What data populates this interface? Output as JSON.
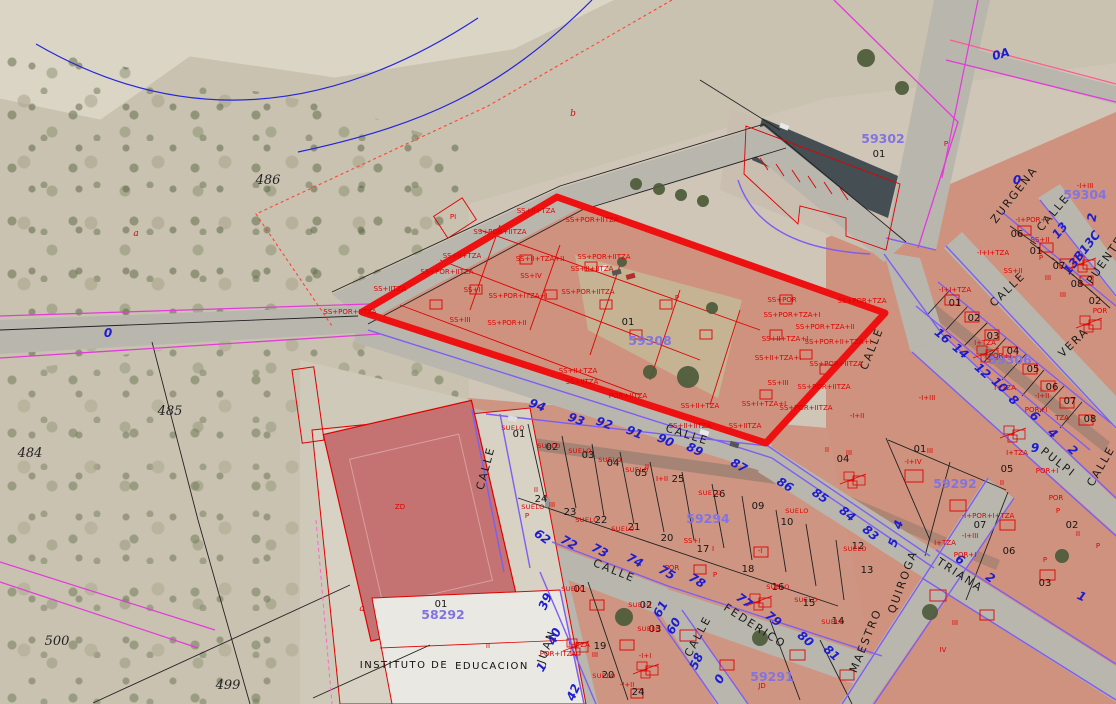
{
  "map": {
    "type": "cadastral-aerial-viewer",
    "highlight": {
      "code": "59308",
      "parcel": "01"
    }
  },
  "colors": {
    "highlight_red": "#ee1111",
    "cadastral_red": "#e00000",
    "street_violet": "#7e5ef2",
    "parcel_purple": "#8274e0",
    "number_blue": "#1d1dcf",
    "magenta": "#e23bd9",
    "contour_blue": "#2626d8",
    "road_gray": "#b9b6ae",
    "block_salmon": "#cf927e"
  },
  "labels": {
    "parcel_codes": [
      [
        "59302",
        883,
        143
      ],
      [
        "59304",
        1085,
        199
      ],
      [
        "59306",
        1010,
        364
      ],
      [
        "59308",
        650,
        345,
        0,
        15
      ],
      [
        "59294",
        708,
        523
      ],
      [
        "59292",
        955,
        488
      ],
      [
        "58292",
        443,
        619
      ],
      [
        "59291",
        772,
        681
      ]
    ],
    "street_names": [
      [
        "ZURGENA",
        1017,
        197,
        -52
      ],
      [
        "CALLE",
        1056,
        215,
        -50
      ],
      [
        "PUENTE",
        1108,
        262,
        -55
      ],
      [
        "CALLE",
        1010,
        292,
        -44
      ],
      [
        "VERA",
        1076,
        345,
        -44
      ],
      [
        "CALLE",
        875,
        350,
        -68
      ],
      [
        "CALLE",
        1104,
        468,
        -60
      ],
      [
        "PULPI",
        1056,
        465,
        38
      ],
      [
        "CALLE",
        686,
        438,
        18
      ],
      [
        "CALLE",
        489,
        469,
        -75
      ],
      [
        "CALLE",
        613,
        574,
        22
      ],
      [
        "FEDERICO",
        753,
        629,
        33
      ],
      [
        "CALLE",
        701,
        638,
        -62
      ],
      [
        "JUAN",
        550,
        648,
        -70
      ],
      [
        "MAESTRO",
        869,
        642,
        -68
      ],
      [
        "QUIROGA",
        906,
        583,
        -70
      ],
      [
        "TRIANA",
        958,
        578,
        33
      ]
    ],
    "street_numbers": [
      [
        "94",
        536,
        409,
        20
      ],
      [
        "93",
        575,
        423,
        20
      ],
      [
        "92",
        603,
        427,
        20
      ],
      [
        "91",
        633,
        436,
        22
      ],
      [
        "90",
        664,
        444,
        24
      ],
      [
        "89",
        693,
        453,
        26
      ],
      [
        "87",
        737,
        469,
        30
      ],
      [
        "86",
        783,
        488,
        32
      ],
      [
        "85",
        818,
        499,
        34
      ],
      [
        "84",
        845,
        517,
        38
      ],
      [
        "83",
        868,
        536,
        40
      ],
      [
        "62",
        540,
        540,
        36
      ],
      [
        "72",
        567,
        546,
        30
      ],
      [
        "73",
        598,
        554,
        28
      ],
      [
        "74",
        633,
        564,
        28
      ],
      [
        "75",
        665,
        576,
        30
      ],
      [
        "78",
        695,
        584,
        32
      ],
      [
        "77",
        742,
        604,
        36
      ],
      [
        "79",
        771,
        622,
        38
      ],
      [
        "80",
        803,
        642,
        40
      ],
      [
        "81",
        829,
        656,
        42
      ],
      [
        "39",
        549,
        603,
        -66
      ],
      [
        "40",
        558,
        638,
        -66
      ],
      [
        "42",
        577,
        694,
        -66
      ],
      [
        "1",
        545,
        669,
        -60
      ],
      [
        "61",
        664,
        611,
        -60
      ],
      [
        "60",
        677,
        628,
        -60
      ],
      [
        "58",
        700,
        663,
        -64
      ],
      [
        "0",
        723,
        681,
        -60
      ],
      [
        "16",
        940,
        339,
        40
      ],
      [
        "14",
        958,
        354,
        40
      ],
      [
        "12",
        980,
        374,
        42
      ],
      [
        "10",
        997,
        388,
        42
      ],
      [
        "8",
        1011,
        403,
        42
      ],
      [
        "6",
        1032,
        419,
        44
      ],
      [
        "4",
        1050,
        436,
        44
      ],
      [
        "2",
        1070,
        453,
        44
      ],
      [
        "9",
        1035,
        452,
        0
      ],
      [
        "0",
        1017,
        184,
        0
      ],
      [
        "13",
        1063,
        233,
        -50
      ],
      [
        "13B13C",
        1085,
        255,
        -52
      ],
      [
        "2",
        1096,
        218,
        -80
      ],
      [
        "0A",
        1002,
        58,
        -15
      ],
      [
        "0",
        108,
        337,
        0
      ],
      [
        "5",
        897,
        544,
        -70
      ],
      [
        "4",
        902,
        526,
        -70
      ],
      [
        "6",
        958,
        563,
        33
      ],
      [
        "2",
        988,
        581,
        35
      ],
      [
        "1",
        1080,
        600,
        25
      ]
    ],
    "parcel_numbers": [
      [
        "01",
        879,
        157
      ],
      [
        "01",
        628,
        325
      ],
      [
        "01",
        441,
        607
      ],
      [
        "01",
        920,
        452
      ],
      [
        "04",
        843,
        462
      ],
      [
        "05",
        1007,
        472
      ],
      [
        "07",
        980,
        528
      ],
      [
        "06",
        1009,
        554
      ],
      [
        "02",
        1072,
        528
      ],
      [
        "03",
        1045,
        586
      ],
      [
        "12",
        858,
        549
      ],
      [
        "13",
        867,
        573
      ],
      [
        "01",
        955,
        306
      ],
      [
        "02",
        974,
        321
      ],
      [
        "03",
        993,
        339
      ],
      [
        "04",
        1013,
        354
      ],
      [
        "05",
        1033,
        372
      ],
      [
        "06",
        1052,
        390
      ],
      [
        "07",
        1070,
        404
      ],
      [
        "08",
        1090,
        422
      ],
      [
        "06",
        1017,
        237
      ],
      [
        "01",
        1036,
        254
      ],
      [
        "07",
        1059,
        269
      ],
      [
        "08",
        1077,
        287
      ],
      [
        "02",
        1095,
        304
      ],
      [
        "01",
        519,
        437
      ],
      [
        "02",
        552,
        450
      ],
      [
        "03",
        588,
        458
      ],
      [
        "04",
        613,
        466
      ],
      [
        "05",
        641,
        476
      ],
      [
        "25",
        678,
        482
      ],
      [
        "26",
        719,
        497
      ],
      [
        "09",
        758,
        509
      ],
      [
        "10",
        787,
        525
      ],
      [
        "24",
        541,
        502
      ],
      [
        "23",
        570,
        515
      ],
      [
        "22",
        601,
        523
      ],
      [
        "21",
        634,
        530
      ],
      [
        "20",
        667,
        541
      ],
      [
        "17",
        703,
        552
      ],
      [
        "18",
        748,
        572
      ],
      [
        "16",
        778,
        590
      ],
      [
        "15",
        809,
        606
      ],
      [
        "14",
        838,
        624
      ],
      [
        "01",
        580,
        592
      ],
      [
        "02",
        646,
        608
      ],
      [
        "03",
        655,
        632
      ],
      [
        "19",
        600,
        649
      ],
      [
        "20",
        608,
        678
      ],
      [
        "24",
        638,
        695
      ]
    ],
    "construction": [
      [
        "SS+II+TZA",
        536,
        213
      ],
      [
        "SS+POR+IITZA",
        592,
        222
      ],
      [
        "SS+POR+IITZA",
        500,
        234
      ],
      [
        "SS+II+TZA",
        462,
        258
      ],
      [
        "SS+II+TZA+II",
        540,
        261
      ],
      [
        "SS+POR+IITZA",
        604,
        259
      ],
      [
        "SS+II+IITZA",
        592,
        271
      ],
      [
        "SS+POR+IITZA",
        447,
        274
      ],
      [
        "SS+IV",
        531,
        278
      ],
      [
        "SS+I",
        472,
        292
      ],
      [
        "SS+POR+ITZA+I",
        518,
        298
      ],
      [
        "SS+POR+IITZA",
        588,
        294
      ],
      [
        "SS+III",
        460,
        322
      ],
      [
        "SS+POR+II",
        507,
        325
      ],
      [
        "SS+POR+IITZA",
        350,
        314
      ],
      [
        "SS+IITZA",
        390,
        291
      ],
      [
        "SS+II+TZA",
        578,
        373
      ],
      [
        "SS+IITZA",
        582,
        384
      ],
      [
        "POR+IITZA",
        628,
        398
      ],
      [
        "SS+II+TZA",
        700,
        408
      ],
      [
        "SS+II+IITZA",
        690,
        428
      ],
      [
        "SS+POR",
        782,
        302
      ],
      [
        "SS+POR+TZA",
        862,
        303
      ],
      [
        "SS+POR+TZA+I",
        792,
        317
      ],
      [
        "SS+POR+TZA+II",
        825,
        329
      ],
      [
        "SS+II+TZA+I",
        785,
        341
      ],
      [
        "SS+POR+II+TZA+I",
        838,
        344
      ],
      [
        "SS+II+TZA+I",
        778,
        360
      ],
      [
        "SS+POR+IITZA",
        836,
        366
      ],
      [
        "SS+III",
        778,
        385
      ],
      [
        "SS+POR+IITZA",
        824,
        389
      ],
      [
        "SS+I+TZA+I",
        764,
        406
      ],
      [
        "SS+POR+IITZA",
        806,
        410
      ],
      [
        "SS+IITZA",
        745,
        428
      ],
      [
        "P",
        946,
        146
      ],
      [
        "PI",
        453,
        219
      ],
      [
        "P",
        677,
        300
      ],
      [
        "-I+III",
        1085,
        188
      ],
      [
        "-I+POR+I",
        1032,
        222
      ],
      [
        "SS+II",
        1040,
        242
      ],
      [
        "SS+II",
        1013,
        273
      ],
      [
        "-I+I+TZA",
        993,
        255
      ],
      [
        "-I+I+TZA",
        955,
        292
      ],
      [
        "III",
        1048,
        280
      ],
      [
        "III",
        1063,
        297
      ],
      [
        "POR",
        1100,
        313
      ],
      [
        "P",
        1041,
        260
      ],
      [
        "-I+III",
        927,
        400
      ],
      [
        "-I+II",
        857,
        418
      ],
      [
        "I+TZA",
        1017,
        455
      ],
      [
        "POR+I",
        1047,
        473
      ],
      [
        "I+TZA",
        1005,
        390
      ],
      [
        "-I+II",
        1042,
        398
      ],
      [
        "POR+I",
        1036,
        412
      ],
      [
        "TZA",
        1062,
        420
      ],
      [
        "I+TZA",
        985,
        345
      ],
      [
        "POR+I",
        1000,
        358
      ],
      [
        "-I+IV",
        913,
        464
      ],
      [
        "III",
        849,
        455
      ],
      [
        "II",
        827,
        452
      ],
      [
        "III",
        930,
        453
      ],
      [
        "II",
        1002,
        485
      ],
      [
        "-I+POR+I+TZA",
        988,
        518
      ],
      [
        "-I+III",
        970,
        538
      ],
      [
        "POR",
        1056,
        500
      ],
      [
        "P",
        1058,
        513
      ],
      [
        "II",
        1078,
        536
      ],
      [
        "I+TZA",
        945,
        545
      ],
      [
        "POR+I",
        965,
        557
      ],
      [
        "III",
        955,
        625
      ],
      [
        "IV",
        943,
        652
      ],
      [
        "P",
        1098,
        548
      ],
      [
        "P",
        1045,
        562
      ],
      [
        "I+II",
        662,
        481
      ],
      [
        "II",
        647,
        469
      ],
      [
        "II",
        536,
        492
      ],
      [
        "III",
        552,
        507
      ],
      [
        "P",
        527,
        518
      ],
      [
        "SS+I",
        692,
        543
      ],
      [
        "I",
        713,
        551
      ],
      [
        "POR",
        672,
        570
      ],
      [
        "-I",
        760,
        553
      ],
      [
        "P",
        715,
        577
      ],
      [
        "I+TZA",
        579,
        647
      ],
      [
        "POR+ITZA",
        558,
        656
      ],
      [
        "III",
        595,
        657
      ],
      [
        "-I+I",
        645,
        658
      ],
      [
        "-I+II",
        627,
        687
      ],
      [
        "II",
        488,
        648
      ],
      [
        "ZD",
        400,
        509,
        0,
        10
      ],
      [
        "JD",
        762,
        688
      ]
    ],
    "suelo": [
      [
        "SUELO",
        513,
        430
      ],
      [
        "SUELO",
        549,
        448
      ],
      [
        "SUELO",
        580,
        453
      ],
      [
        "SUELO",
        610,
        462
      ],
      [
        "SUELO",
        637,
        472
      ],
      [
        "SUELO",
        533,
        509
      ],
      [
        "SUELO",
        587,
        522
      ],
      [
        "SUELO",
        623,
        531
      ],
      [
        "SUELO",
        710,
        495
      ],
      [
        "SUELO",
        797,
        513
      ],
      [
        "SUELO",
        855,
        551
      ],
      [
        "SUELO",
        833,
        624
      ],
      [
        "SUELO",
        806,
        602
      ],
      [
        "SUELO",
        778,
        589
      ],
      [
        "SUELO",
        573,
        591
      ],
      [
        "SUELO",
        640,
        607
      ],
      [
        "SUELO",
        649,
        631
      ],
      [
        "SUELO",
        604,
        678
      ]
    ],
    "terrain": [
      [
        "486",
        268,
        184
      ],
      [
        "485",
        170,
        415
      ],
      [
        "484",
        30,
        457
      ],
      [
        "500",
        57,
        645
      ],
      [
        "499",
        228,
        689
      ]
    ],
    "letters": [
      [
        "a",
        136,
        236
      ],
      [
        "b",
        573,
        116
      ],
      [
        "a",
        362,
        611
      ]
    ],
    "misc_black": [
      [
        "INSTITUTO DE",
        404,
        668
      ],
      [
        "EDUCACION",
        492,
        669
      ]
    ]
  }
}
